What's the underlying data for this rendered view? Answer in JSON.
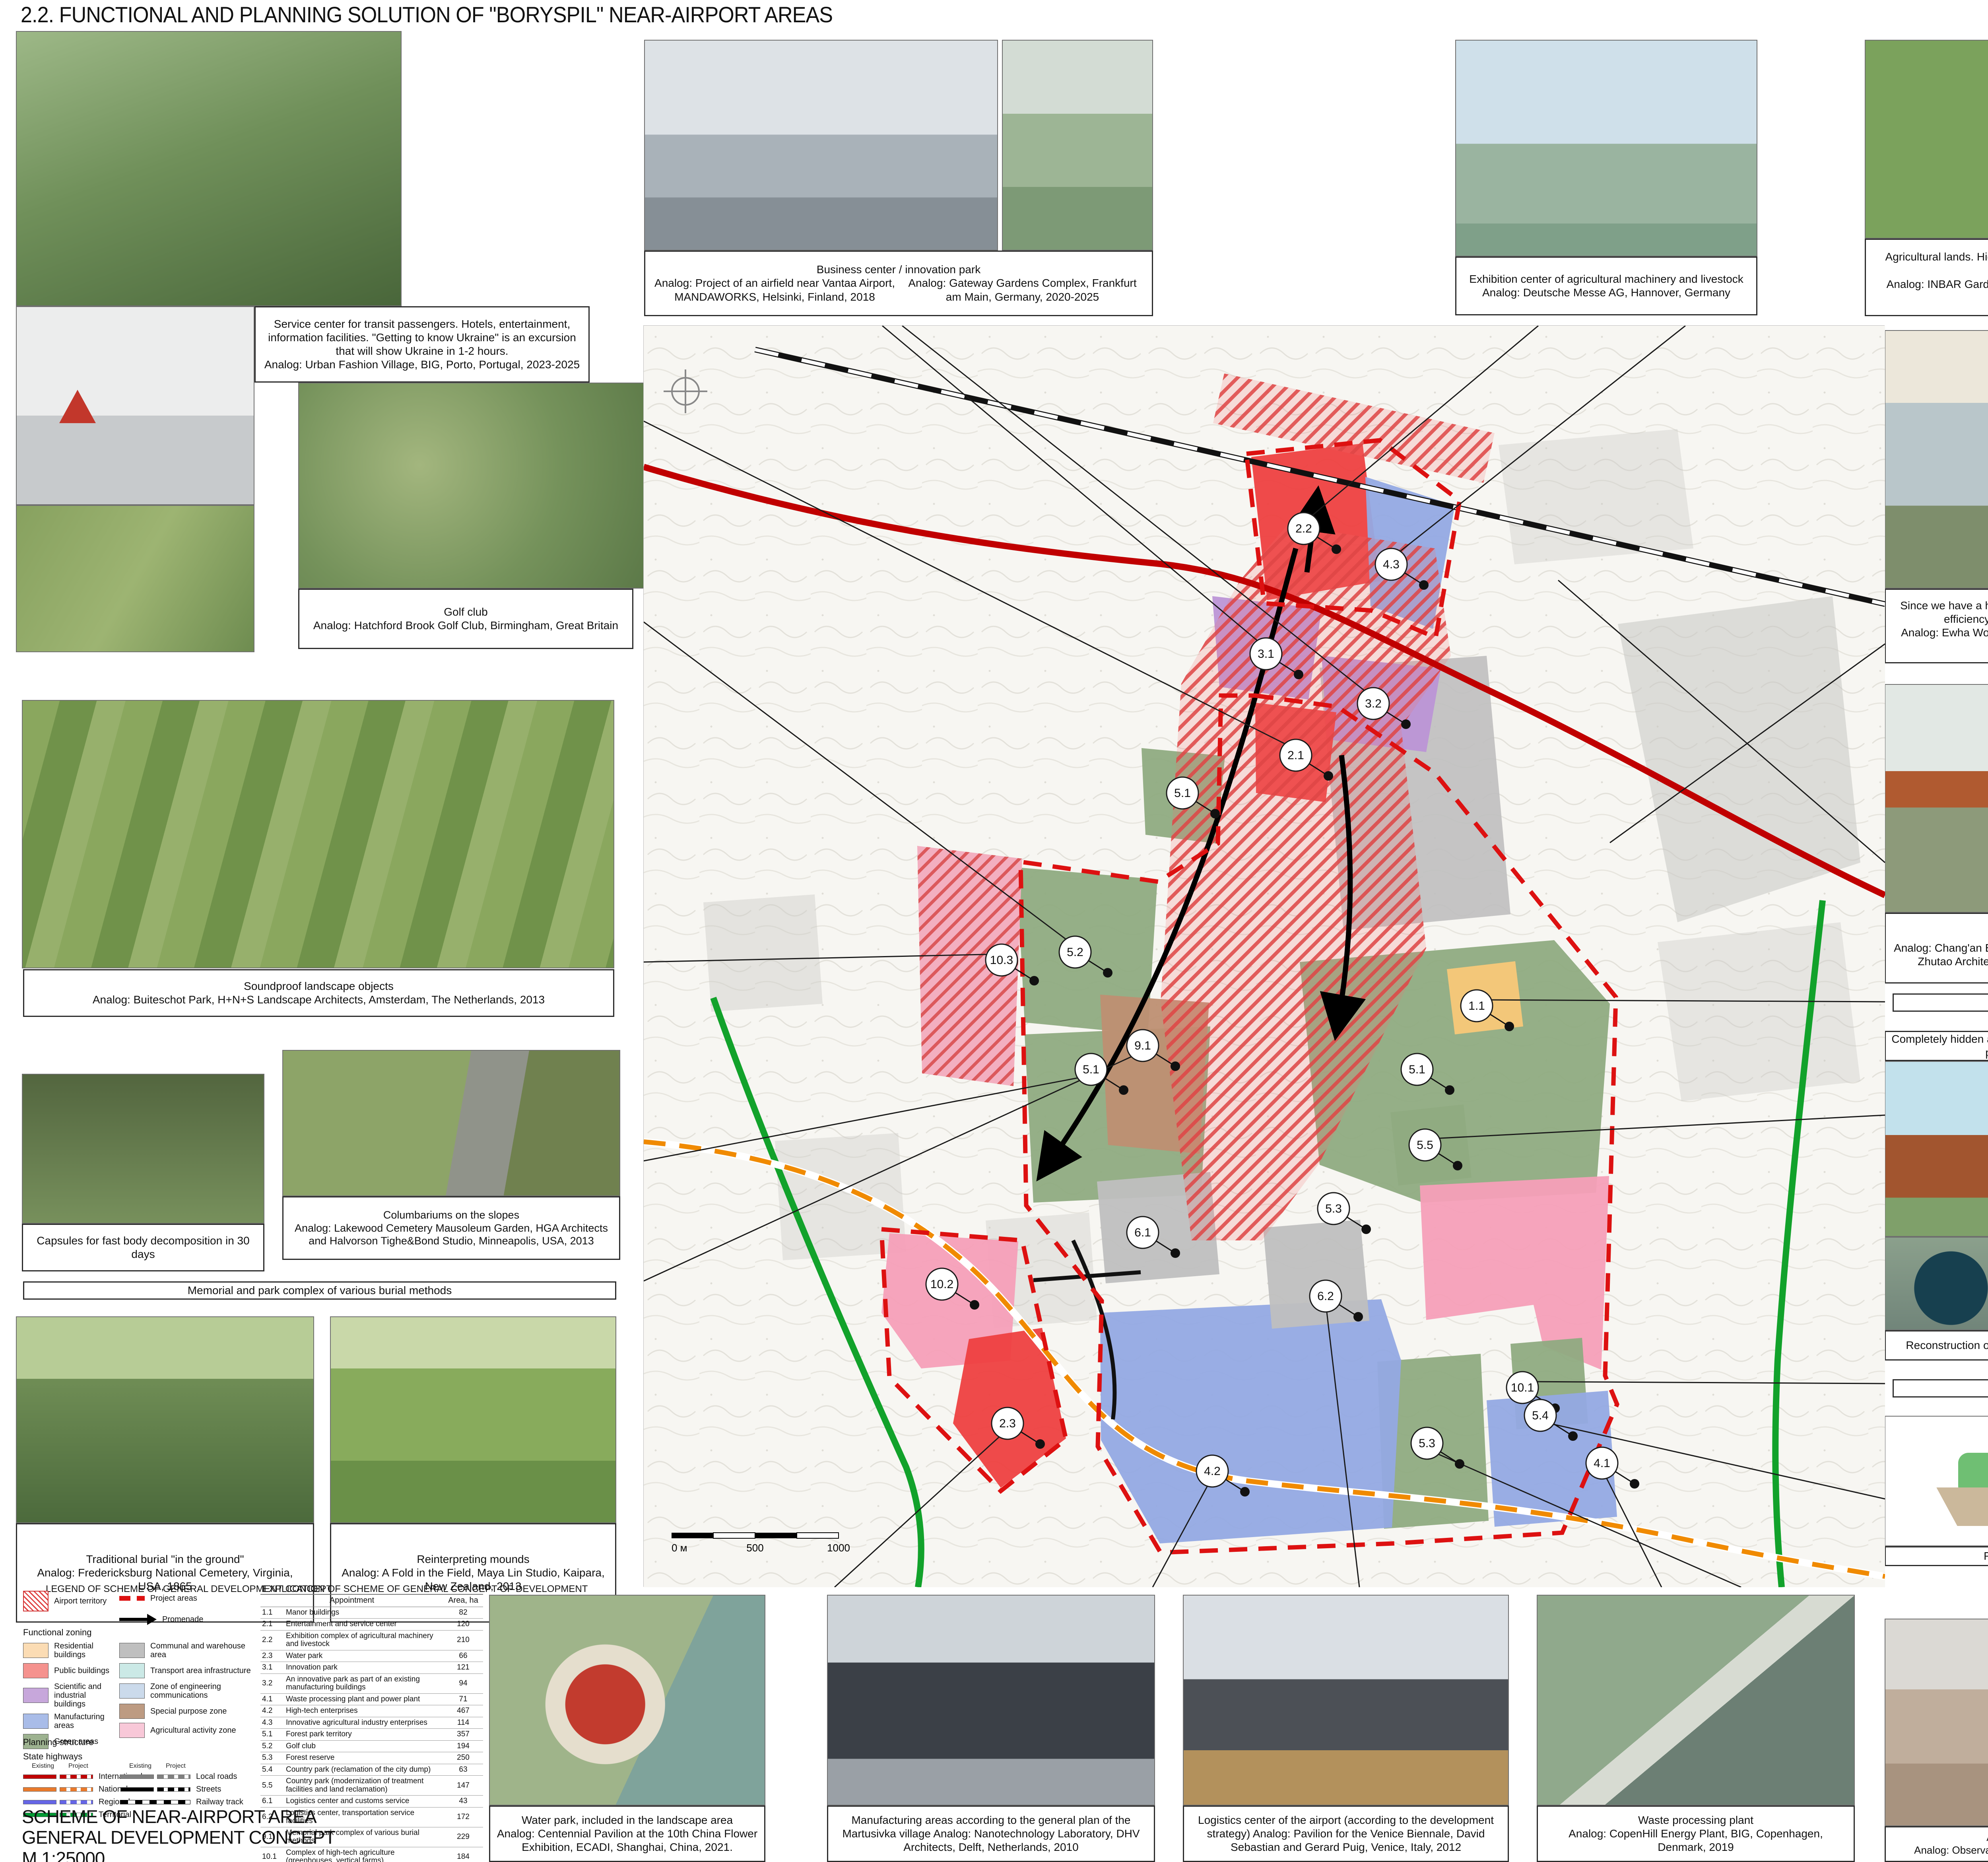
{
  "title": "2.2. FUNCTIONAL AND PLANNING SOLUTION OF \"BORYSPIL\" NEAR-AIRPORT AREAS",
  "captions": {
    "service_center": {
      "body": "Service center for transit passengers. Hotels, entertainment, information facilities. \"Getting to know Ukraine\" is an excursion that will show Ukraine in 1-2 hours.",
      "analog": "Analog: Urban Fashion Village, BIG, Porto, Portugal, 2023-2025"
    },
    "golf": {
      "title": "Golf club",
      "analog": "Analog: Hatchford Brook Golf Club, Birmingham, Great Britain"
    },
    "business": {
      "title": "Business center / innovation park",
      "analog_left": "Analog: Project of an airfield near Vantaa Airport, MANDAWORKS, Helsinki, Finland, 2018",
      "analog_right": "Analog: Gateway Gardens Complex, Frankfurt am Main, Germany, 2020-2025"
    },
    "exhibition": {
      "title": "Exhibition center of agricultural machinery and livestock",
      "analog": "Analog: Deutsche Messe AG, Hannover, Germany"
    },
    "agri_top": {
      "title": "Agricultural lands. High-tech agro-industrial enterprises: greenhouses, vertical farms",
      "analog": "Analog: INBAR Garden Pavilion, Cardenas Conscious Design Studio, Yanqing, China, 2019"
    },
    "underground": {
      "body": "Since we have a height limit, we can build underground. The energy efficiency of this solution will be an additional plus.",
      "analog": "Analog: Ewha Womans University, Dominique Perrault Architecture, Seoul, South Korea, 2008"
    },
    "crossings": {
      "title": "Crossings over the track",
      "analog": "Analog: Chang'an Experimental Elementary School Pedestrian Bridge, Zhutao Architecture Design Studio, Guangdong, China, 2019"
    },
    "manor_bar": "Manor buildings",
    "sewage_title": "Completely hidden and compact sewage treatment plants - \"Megapolis\" project (ECOSGROUP company)",
    "reconstruction": "Reconstruction of treatment facilities + arrangement of park areas",
    "agri_bar": "Agricultural lands",
    "reclamation": "Reclamation of the garbage dump",
    "soundproof": {
      "title": "Soundproof landscape objects",
      "analog": "Analog: Buiteschot Park, H+N+S Landscape Architects, Amsterdam, The Netherlands, 2013"
    },
    "capsules": "Capsules for fast body decomposition in 30 days",
    "columbarium": {
      "title": "Columbariums on the slopes",
      "analog": "Analog: Lakewood Cemetery Mausoleum Garden, HGA Architects and Halvorson Tighe&Bond Studio, Minneapolis, USA, 2013"
    },
    "memorial_bar": "Memorial and park complex of various burial methods",
    "traditional": {
      "title": "Traditional burial \"in the ground\"",
      "analog": "Analog: Fredericksburg National Cemetery, Virginia, USA, 1865"
    },
    "mounds": {
      "title": "Reinterpreting mounds",
      "analog": "Analog: A Fold in the Field, Maya Lin Studio, Kaipara, New Zealand, 2013"
    },
    "water_park": {
      "title": "Water park, included in the landscape area",
      "analog": "Analog: Centennial Pavilion at the 10th China Flower Exhibition, ECADI, Shanghai, China, 2021."
    },
    "manufacturing": {
      "body": "Manufacturing areas according to the general plan of the Martusivka village",
      "analog": "Analog: Nanotechnology Laboratory, DHV Architects, Delft, Netherlands, 2010"
    },
    "logistics": {
      "body": "Logistics center of the airport (according to the development strategy)",
      "analog": "Analog: Pavilion for the Venice Biennale, David Sebastian and Gerard Puig, Venice, Italy, 2012"
    },
    "waste": {
      "title": "Waste processing plant",
      "analog": "Analog: CopenHill Energy Plant, BIG, Copenhagen, Denmark, 2019"
    },
    "forest": {
      "title": "A forest park with viewing platforms",
      "analog": "Analog: Observation tower, EFFEKT, Copenhagen, Denmark, 2016"
    }
  },
  "legend": {
    "header": "LEGEND OF SCHEME OF GENERAL DEVELOPMENT CONCEPT",
    "airport_territory": "Airport territory",
    "project_areas": "Project areas",
    "promenade": "Promenade",
    "functional_zoning_title": "Functional zoning",
    "zoning_left": [
      {
        "label": "Residential buildings",
        "color": "#FBDCB4"
      },
      {
        "label": "Public buildings",
        "color": "#F5928E"
      },
      {
        "label": "Scientific and industrial buildings",
        "color": "#C7A7DB"
      },
      {
        "label": "Manufacturing areas",
        "color": "#A9BCE8"
      },
      {
        "label": "Green areas",
        "color": "#9DB290"
      }
    ],
    "zoning_right": [
      {
        "label": "Communal and warehouse area",
        "color": "#BFBFBF"
      },
      {
        "label": "Transport area infrastructure",
        "color": "#CBE9E6"
      },
      {
        "label": "Zone of engineering communications",
        "color": "#CBDAEB"
      },
      {
        "label": "Special purpose zone",
        "color": "#BD9B82"
      },
      {
        "label": "Agricultural activity zone",
        "color": "#F8C8D8"
      }
    ],
    "planning_structure_title": "Planning structure",
    "state_highways_title": "State highways",
    "col_existing": "Existing",
    "col_project": "Project",
    "roads_left": [
      {
        "label": "International",
        "color": "#C00000"
      },
      {
        "label": "National",
        "color": "#E97A2C"
      },
      {
        "label": "Regional",
        "color": "#6666E6"
      },
      {
        "label": "Territorial",
        "color": "#009933"
      }
    ],
    "roads_right": [
      {
        "label": "Local roads",
        "color": "#7F7F7F"
      },
      {
        "label": "Streets",
        "color": "#000000"
      },
      {
        "label": "Railway track",
        "color": "railway"
      }
    ]
  },
  "explication": {
    "header": "EXPLICATION OF SCHEME OF GENERAL CONCEPT OF DEVELOPMENT",
    "col_name": "Appointment",
    "col_area": "Area, ha",
    "rows": [
      {
        "code": "1.1",
        "name": "Manor buildings",
        "area": "82"
      },
      {
        "code": "2.1",
        "name": "Entertainment and service center",
        "area": "120"
      },
      {
        "code": "2.2",
        "name": "Exhibition complex of agricultural machinery and livestock",
        "area": "210"
      },
      {
        "code": "2.3",
        "name": "Water park",
        "area": "66"
      },
      {
        "code": "3.1",
        "name": "Innovation park",
        "area": "121"
      },
      {
        "code": "3.2",
        "name": "An innovative park as part of an existing manufacturing buildings",
        "area": "94"
      },
      {
        "code": "4.1",
        "name": "Waste processing plant and power plant",
        "area": "71"
      },
      {
        "code": "4.2",
        "name": "High-tech enterprises",
        "area": "467"
      },
      {
        "code": "4.3",
        "name": "Innovative agricultural industry enterprises",
        "area": "114"
      },
      {
        "code": "5.1",
        "name": "Forest park territory",
        "area": "357"
      },
      {
        "code": "5.2",
        "name": "Golf club",
        "area": "194"
      },
      {
        "code": "5.3",
        "name": "Forest reserve",
        "area": "250"
      },
      {
        "code": "5.4",
        "name": "Country park (reclamation of the city dump)",
        "area": "63"
      },
      {
        "code": "5.5",
        "name": "Country park (modernization of treatment facilities and land reclamation)",
        "area": "147"
      },
      {
        "code": "6.1",
        "name": "Logistics center and customs service",
        "area": "43"
      },
      {
        "code": "6.2",
        "name": "Logistics center, transportation service facilities",
        "area": "172"
      },
      {
        "code": "9.1",
        "name": "Memorial park complex of various burial methods",
        "area": "229"
      },
      {
        "code": "10.1",
        "name": "Complex of high-tech agriculture (greenhouses, vertical farms)",
        "area": "184"
      },
      {
        "code": "10.2",
        "name": "Agricultural lands instead of the planned cemetery",
        "area": "141"
      },
      {
        "code": "10.3",
        "name": "Agricultural land for cereal crops in the summer / snowkiting training ground in the winter",
        "area": "225"
      }
    ],
    "total": "3 350 m²"
  },
  "scheme_block": {
    "line1": "SCHEME OF NEAR-AIRPORT AREA",
    "line2": "GENERAL DEVELOPMENT CONCEPT",
    "line3": "M 1:25000"
  },
  "map": {
    "labels": [
      "2.2",
      "4.3",
      "3.1",
      "3.2",
      "2.1",
      "5.1",
      "5.2",
      "10.3",
      "1.1",
      "9.1",
      "5.1",
      "5.1",
      "5.5",
      "5.3",
      "6.1",
      "10.2",
      "6.2",
      "10.1",
      "5.4",
      "2.3",
      "5.3",
      "4.2",
      "4.1"
    ],
    "scale_labels": [
      "0 м",
      "500",
      "1000"
    ],
    "colors": {
      "boundary_red": "#DD1111",
      "airport_hatch": "#E04545",
      "road_international": "#C00000",
      "road_territorial": "#12A22B",
      "road_project_orange": "#F08A00",
      "railway": "#111111"
    }
  },
  "dump_diagram": {
    "label_top": "растения",
    "label_inner": "мусор"
  }
}
